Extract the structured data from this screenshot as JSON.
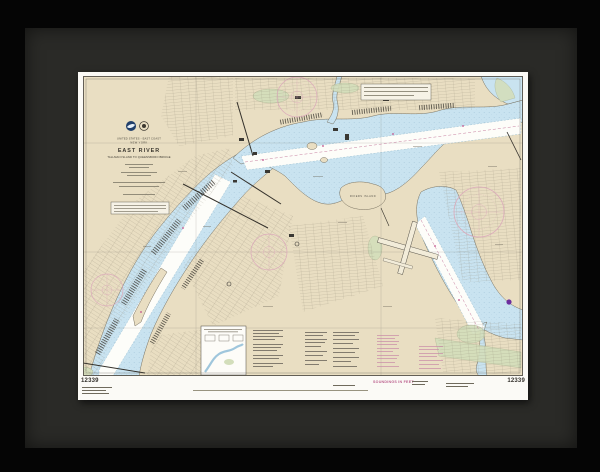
{
  "artwork": {
    "kind": "framed nautical chart print",
    "frame": {
      "frame_color": "#050505",
      "matte_color": "#2a2a27",
      "paper_color": "#fbfaf6"
    },
    "chart": {
      "title_block": {
        "country_line": "UNITED STATES - EAST COAST",
        "state_line": "NEW YORK",
        "title": "EAST RIVER",
        "subtitle": "TALLMAN ISLAND TO QUEENSBORO BRIDGE"
      },
      "margin": {
        "chart_number_left": "12339",
        "chart_number_right": "12339",
        "soundings_label": "SOUNDINGS IN FEET"
      },
      "map_labels": {
        "rikers_island": "RIKERS ISLAND"
      },
      "colors": {
        "land": "#e9dec2",
        "water": "#c9e3f0",
        "channel": "#fdfdf9",
        "marsh": "#d3debb",
        "compass_magenta": "#dcaabb",
        "note_magenta": "#c98aa7",
        "ink": "#3c3830"
      },
      "icons": [
        "noaa-logo",
        "commerce-seal",
        "compass-rose"
      ]
    }
  }
}
